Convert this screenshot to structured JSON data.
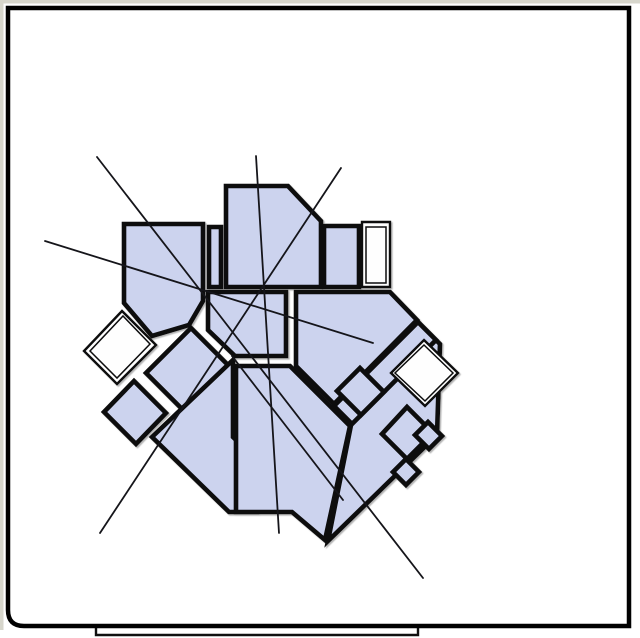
{
  "figure": {
    "description": "rotated-floor-plan-diagram",
    "canvas": {
      "width": 640,
      "height": 638,
      "background": "#ffffff",
      "outer_margin_color": "#d7d6cc"
    },
    "frame": {
      "stroke": "#010101",
      "stroke_width": 4.5,
      "left": 8,
      "top": 8,
      "right": 629,
      "bottom": 626,
      "corner_radius_bottom_left": 16
    },
    "underlay_sheet_edge": {
      "points": "96,627 96,635 418,635 418,628",
      "stroke": "#101010",
      "width": 2.4
    },
    "plan": {
      "room_fill": "#ccd3ee",
      "white_fill": "#fefefe",
      "wall_color": "#0a0a0c",
      "wall_width": 4.6,
      "annex_outline_width": 2.4,
      "annex_inner_width": 1.5,
      "shadow_color": "#9a9a9a",
      "rooms": [
        {
          "name": "room-south-band-west",
          "fill": "blue",
          "points": "191,328 276,413 231,458 146,373"
        },
        {
          "name": "room-south-fan-left",
          "fill": "blue",
          "points": "233,360 233,437 257,460 257,512 229,512 152,437"
        },
        {
          "name": "room-south-hall",
          "fill": "blue",
          "points": "236,366 290,366 332,408 350,426 325,540 292,512 236,512"
        },
        {
          "name": "room-wing-base",
          "fill": "blue",
          "points": "418,322 440,344 437,435 328,541 351,425 334,406"
        },
        {
          "name": "room-wing-corridor",
          "fill": "blue",
          "points": "418,322 436,340 352,424 334,406"
        },
        {
          "name": "room-east-main",
          "fill": "blue",
          "points": "296,292 390,292 417,320 334,404 296,366"
        },
        {
          "name": "room-center-hall",
          "fill": "blue",
          "points": "208,292 286,292 286,356 235,356 208,330"
        },
        {
          "name": "room-center-strip",
          "fill": "blue",
          "points": "209,227 221,227 221,287 209,287"
        },
        {
          "name": "room-top-pentagon",
          "fill": "blue",
          "points": "226,186 288,186 321,221 321,287 226,287"
        },
        {
          "name": "room-top-small",
          "fill": "blue",
          "points": "324,226 359,226 359,287 324,287"
        },
        {
          "name": "room-top-left",
          "fill": "blue",
          "points": "124,224 203,224 203,301 189,325 152,336 124,303"
        },
        {
          "name": "room-west-diamond",
          "fill": "blue",
          "points": "134,381 166,413 136,444 104,412"
        },
        {
          "name": "room-wing-cell-1",
          "fill": "blue",
          "points": "360,368 384,392 361,415 337,391"
        },
        {
          "name": "room-wing-cell-2",
          "fill": "blue",
          "points": "407,407 433,433 407,459 382,434"
        },
        {
          "name": "room-wing-cell-3",
          "fill": "blue",
          "points": "406,459 419,472 406,485 393,472"
        },
        {
          "name": "room-wing-cell-4",
          "fill": "blue",
          "points": "428,422 442,436 429,449 415,435"
        }
      ],
      "white_annexes": [
        {
          "name": "annex-north-east-rect",
          "outer": "362,222 390,222 390,287 362,287",
          "inner": "366,227 386,227 386,283 366,283"
        },
        {
          "name": "annex-west-diamond",
          "outer": "122,311 156,345 117,384 84,351",
          "inner": "123,316 150,344 117,378 90,351"
        },
        {
          "name": "annex-east-diamond",
          "outer": "424,340 458,373 425,406 391,373",
          "inner": "424,345 453,373 425,401 395,373"
        }
      ],
      "annotation_lines": {
        "color": "#15151a",
        "width": 1.8,
        "segments": [
          {
            "name": "sight-line-nw-se",
            "x1": 97,
            "y1": 157,
            "x2": 423,
            "y2": 578
          },
          {
            "name": "sight-line-vertical",
            "x1": 256,
            "y1": 156,
            "x2": 279,
            "y2": 533
          },
          {
            "name": "sight-line-ne-sw",
            "x1": 341,
            "y1": 168,
            "x2": 100,
            "y2": 533
          },
          {
            "name": "sight-line-shallow",
            "x1": 45,
            "y1": 241,
            "x2": 373,
            "y2": 343
          },
          {
            "name": "sight-line-center-se",
            "x1": 232,
            "y1": 356,
            "x2": 343,
            "y2": 500
          }
        ]
      }
    }
  }
}
